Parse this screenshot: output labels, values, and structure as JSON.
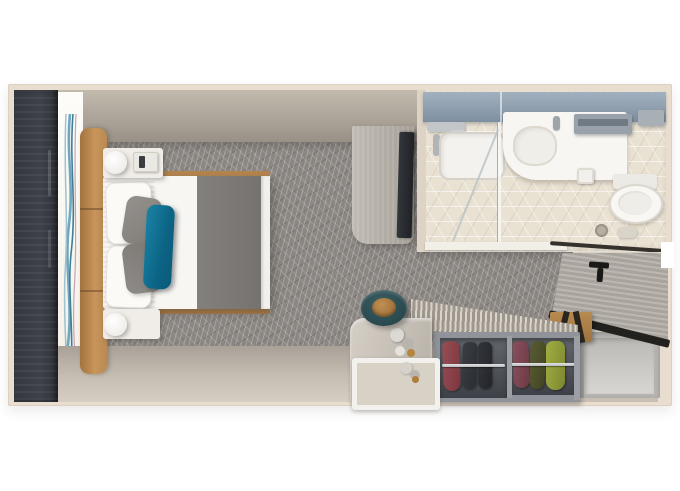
{
  "meta": {
    "kind": "floor-plan-3d-render",
    "subject": "cruise-ship-stateroom-top-down",
    "canvas": {
      "width_px": 680,
      "height_px": 491,
      "background": "#ffffff"
    },
    "visible_text": "none"
  },
  "palette": {
    "outer_wall": "#e9ddcf",
    "bedroom_wall_band": "#a59d92",
    "carpet_base": "#8b8682",
    "carpet_pattern_lines": "#f4f3f1",
    "balcony_window_band": "#3b3e45",
    "headboard_leather": "#c8955b",
    "wall_art_accents": [
      "#6fa7bd",
      "#3f7e97",
      "#9cc3d2",
      "#c9a3b4"
    ],
    "bed_linen": "#f7f6f3",
    "bed_runner": "#7c7976",
    "accent_pillow_teal": "#0f7290",
    "gray_pillow": "#8b8884",
    "bed_frame_wood": "#b5854e",
    "tv_cabinet_wood": "#b0aba2",
    "tv_panel": "#26282c",
    "bathroom_floor_tile": "#e9e1d2",
    "bathroom_mirror_band": "#8fa0b0",
    "fixtures_white": "#f7f6f3",
    "chrome": "#b2b5b8",
    "entry_floor": "#d0c7ba",
    "door_wood": "#b2aea7",
    "door_trim": "#23211e",
    "wardrobe_frame": "#90949a",
    "wardrobe_interior": "#4a4e54",
    "hanging_clothes": [
      "#8d4a50",
      "#33363b",
      "#2b2e33",
      "#7c4550",
      "#4f5230",
      "#9aa43c"
    ],
    "stool_ring": "#2c4d52",
    "stool_seat": "#b07c42",
    "desk_wood": "#c9c3ba",
    "tray_rim": "#f3f1ed",
    "bench_wood": "#b08149"
  },
  "scene": {
    "bedroom": {
      "balcony_window_band": {
        "side": "left",
        "color": "#3b3e45"
      },
      "wall_art": {
        "style": "wavy-vertical-lines",
        "colors": [
          "#6fa7bd",
          "#3f7e97",
          "#9cc3d2",
          "#c9a3b4"
        ]
      },
      "headboard": {
        "color": "#c8955b",
        "segments": 3
      },
      "bed": {
        "linen": "#f7f6f3",
        "runner": "#7c7976",
        "pillows": {
          "white": 2,
          "gray": 2,
          "teal_accent": 1,
          "teal_color": "#0f7290"
        }
      },
      "nightstands": {
        "count": 2,
        "lamps": 2,
        "phone_on_top_nightstand": true
      },
      "carpet": {
        "pattern": "geometric-line-triangles",
        "base": "#8b8682"
      },
      "tv_cabinet": {
        "tv_mounted": true,
        "tv_color": "#26282c"
      }
    },
    "bathroom": {
      "mirror_counter_band": "#8fa0b0",
      "shower": {
        "glass_partition": true,
        "chrome_fixtures": true,
        "tray": "#f4f2ee"
      },
      "vanity": {
        "counter": "#f7f6f3",
        "basin": "#efeee9",
        "faucet": "#9fa4a8"
      },
      "toilet": {
        "bowl": "#f8f7f4",
        "tank": "#eceae5",
        "paper_holder": true
      },
      "towel_shelves": 2,
      "floor": {
        "tile": "hex-cube-pattern",
        "color": "#e9e1d2"
      },
      "towel_rail_dark": "#35312c"
    },
    "entry": {
      "door": {
        "state": "open",
        "wood": "#b2aea7",
        "trim": "#23211e",
        "handle": "T-bar-black"
      },
      "open_cabinet": {
        "color": "#b5b3af"
      },
      "luggage_bench": {
        "wood": "#b08149",
        "straps": "#2a251f"
      }
    },
    "wardrobe": {
      "compartments": 2,
      "slatted_top_shelf": true,
      "rails": 2,
      "clothes_colors": [
        "#8d4a50",
        "#33363b",
        "#2b2e33",
        "#7c4550",
        "#4f5230",
        "#9aa43c"
      ]
    },
    "desk_area": {
      "desk_wood": "#c9c3ba",
      "pullout_tray": {
        "rim": "#f3f1ed",
        "inner": "#d8d1c5"
      },
      "flower_arrangements": 2,
      "stool": {
        "ring": "#2c4d52",
        "seat": "#b07c42"
      }
    }
  }
}
